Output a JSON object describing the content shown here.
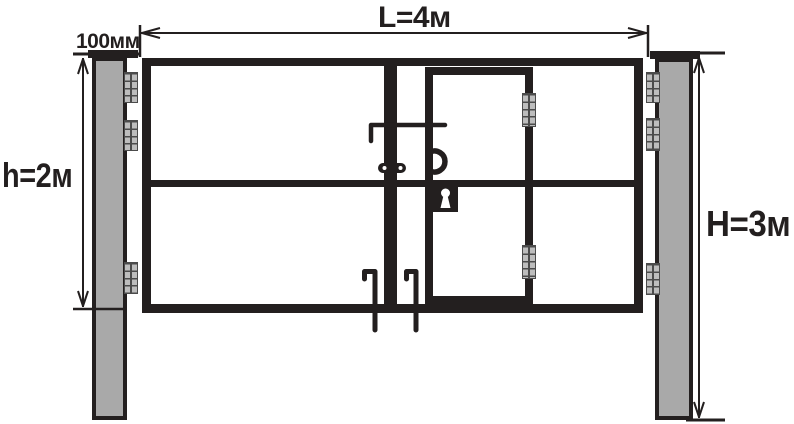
{
  "labels": {
    "gate_width": "L=4м",
    "post_width": "100мм",
    "gate_height": "h=2м",
    "post_height": "H=3м"
  },
  "colors": {
    "ink": "#231f1f",
    "post_fill": "#a9a9a9",
    "hinge_fill": "#bdbdbd",
    "hinge_grid": "#4b4b4b",
    "background": "#ffffff"
  },
  "components": {
    "gate_leaf_count": 2,
    "wicket_door": true,
    "gate_hinges_left": 3,
    "gate_hinges_right": 3,
    "door_hinges": 2,
    "drop_bolts": 2,
    "door_handle": true,
    "lock_keyhole": true
  }
}
